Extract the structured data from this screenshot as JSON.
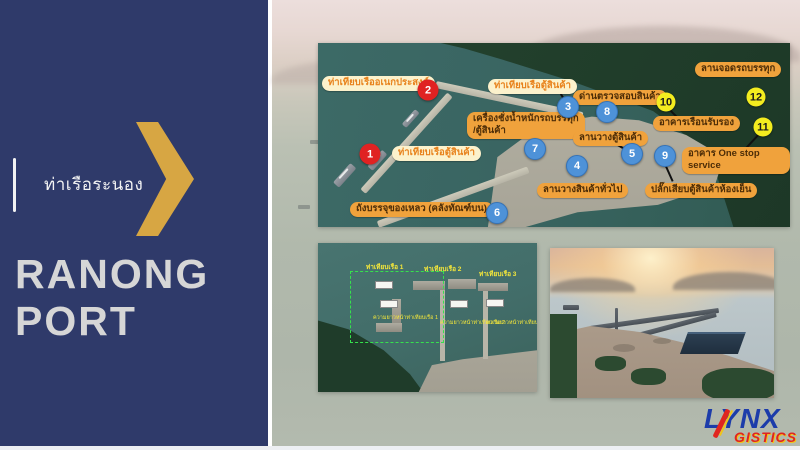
{
  "sidebar": {
    "thai_title": "ท่าเรือระนอง",
    "title_line1": "RANONG",
    "title_line2": "PORT",
    "colors": {
      "panel": "#2f3a6a",
      "chevron_gold": "#d7a643",
      "title_text": "#d6d6d6"
    }
  },
  "main_map": {
    "markers": [
      {
        "n": "1",
        "color": "red",
        "x": 52,
        "y": 111
      },
      {
        "n": "2",
        "color": "red",
        "x": 110,
        "y": 47
      },
      {
        "n": "3",
        "color": "blue",
        "x": 250,
        "y": 64
      },
      {
        "n": "4",
        "color": "blue",
        "x": 259,
        "y": 123
      },
      {
        "n": "5",
        "color": "blue",
        "x": 314,
        "y": 111
      },
      {
        "n": "6",
        "color": "blue",
        "x": 179,
        "y": 170
      },
      {
        "n": "7",
        "color": "blue",
        "x": 217,
        "y": 106
      },
      {
        "n": "8",
        "color": "blue",
        "x": 289,
        "y": 69
      },
      {
        "n": "9",
        "color": "blue",
        "x": 347,
        "y": 113
      },
      {
        "n": "10",
        "color": "yellow",
        "x": 348,
        "y": 59
      },
      {
        "n": "11",
        "color": "yellow",
        "x": 445,
        "y": 84
      },
      {
        "n": "12",
        "color": "yellow",
        "x": 438,
        "y": 54
      }
    ],
    "labels": [
      {
        "text": "ท่าเทียบเรืออเนกประสงค์",
        "style": "light",
        "x": 4,
        "y": 33
      },
      {
        "text": "ท่าเทียบเรือตู้สินค้า",
        "style": "light",
        "x": 170,
        "y": 36
      },
      {
        "text": "ด่านตรวจสอบสินค้า",
        "style": "solid",
        "x": 255,
        "y": 47
      },
      {
        "text": "ลานจอดรถบรรทุก",
        "style": "solid",
        "x": 377,
        "y": 19
      },
      {
        "text": "เครื่องชั่งน้ำหนักรถบรรทุก\n/ตู้สินค้า",
        "style": "solid",
        "x": 149,
        "y": 69
      },
      {
        "text": "อาคารเรือนรับรอง",
        "style": "solid",
        "x": 335,
        "y": 73
      },
      {
        "text": "ลานวางตู้สินค้า",
        "style": "solid",
        "x": 255,
        "y": 88
      },
      {
        "text": "อาคาร One stop service",
        "style": "solid",
        "x": 364,
        "y": 104
      },
      {
        "text": "ท่าเทียบเรือตู้สินค้า",
        "style": "light",
        "x": 74,
        "y": 103
      },
      {
        "text": "ลานวางสินค้าทั่วไป",
        "style": "solid",
        "x": 219,
        "y": 140
      },
      {
        "text": "ปลั๊กเสียบตู้สินค้าห้องเย็น",
        "style": "solid",
        "x": 327,
        "y": 140
      },
      {
        "text": "ถังบรรจุของเหลว (คลังทัณฑ์บน)",
        "style": "solid",
        "x": 32,
        "y": 159
      }
    ],
    "connectors": [
      {
        "x": 352,
        "y": 66,
        "len": 19,
        "deg": 45
      },
      {
        "x": 428,
        "y": 104,
        "len": 19,
        "deg": -47
      },
      {
        "x": 298,
        "y": 100,
        "len": 14,
        "deg": 30
      },
      {
        "x": 348,
        "y": 122,
        "len": 17,
        "deg": 66
      },
      {
        "x": 243,
        "y": 50,
        "len": 12,
        "deg": 59
      }
    ]
  },
  "detail_map": {
    "berth_labels": [
      {
        "text": "ท่าเทียบเรือ 1",
        "x": 48,
        "y": 19
      },
      {
        "text": "ท่าเทียบเรือ 2",
        "x": 106,
        "y": 21
      },
      {
        "text": "ท่าเทียบเรือ 3",
        "x": 161,
        "y": 26
      }
    ],
    "length_labels": [
      {
        "text": "ความยาวหน้าท่าเทียบเรือ 1",
        "x": 55,
        "y": 71
      },
      {
        "text": "ความยาวหน้าท่าเทียบเรือ 2",
        "x": 122,
        "y": 76
      },
      {
        "text": "ความยาวหน้าท่าเทียบเรือ 3",
        "x": 168,
        "y": 76
      }
    ],
    "dim_boxes": [
      {
        "x": 57,
        "y": 38
      },
      {
        "x": 62,
        "y": 57
      },
      {
        "x": 132,
        "y": 57
      },
      {
        "x": 168,
        "y": 56
      }
    ]
  },
  "logo": {
    "top": "LYNX",
    "bottom": "GISTICS",
    "blue": "#1c3caa",
    "red": "#e0251f",
    "yellow": "#f0c419"
  }
}
